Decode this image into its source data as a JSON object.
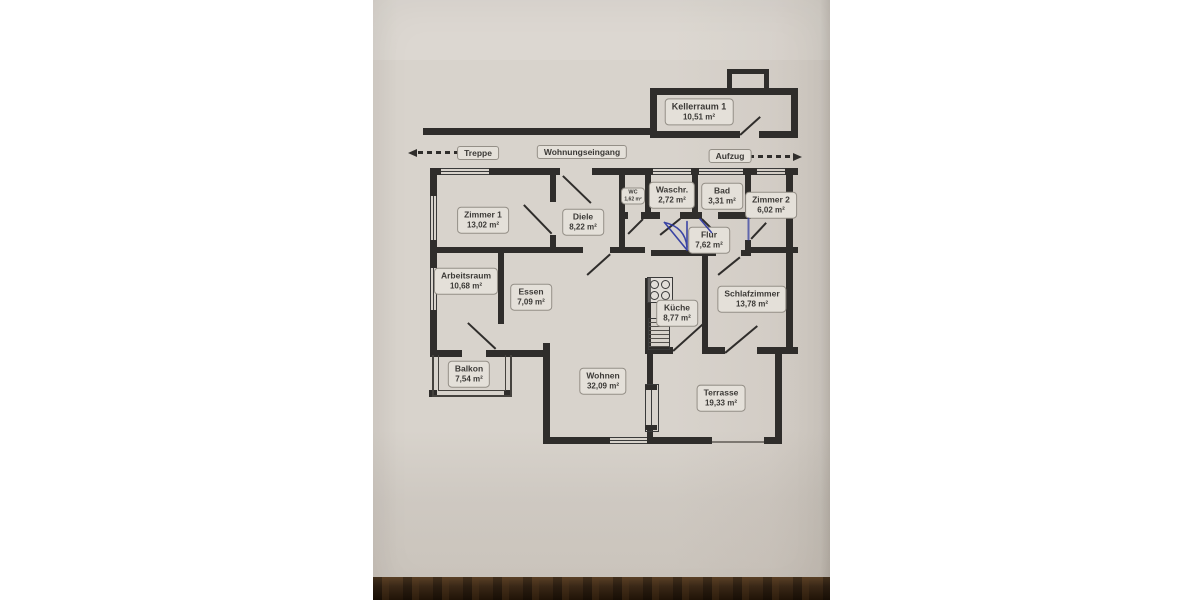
{
  "colors": {
    "canvas": "#ffffff",
    "paper": "#d7d2cb",
    "ink": "#2f2d2b",
    "pen_blue": "#2a35a0",
    "wood": "#3a2817"
  },
  "plan": {
    "rooms": [
      {
        "id": "kellerraum",
        "name": "Kellerraum 1",
        "area": "10,51 m²"
      },
      {
        "id": "zimmer1",
        "name": "Zimmer 1",
        "area": "13,02 m²"
      },
      {
        "id": "diele",
        "name": "Diele",
        "area": "8,22 m²"
      },
      {
        "id": "wc",
        "name": "WC",
        "area": "1,62 m²"
      },
      {
        "id": "waschraum",
        "name": "Waschr.",
        "area": "2,72 m²"
      },
      {
        "id": "bad",
        "name": "Bad",
        "area": "3,31 m²"
      },
      {
        "id": "zimmer2",
        "name": "Zimmer 2",
        "area": "6,02 m²"
      },
      {
        "id": "flur",
        "name": "Flur",
        "area": "7,62 m²"
      },
      {
        "id": "arbeitsraum",
        "name": "Arbeitsraum",
        "area": "10,68 m²"
      },
      {
        "id": "essen",
        "name": "Essen",
        "area": "7,09 m²"
      },
      {
        "id": "kueche",
        "name": "Küche",
        "area": "8,77 m²"
      },
      {
        "id": "schlafzimmer",
        "name": "Schlafzimmer",
        "area": "13,78 m²"
      },
      {
        "id": "balkon",
        "name": "Balkon",
        "area": "7,54 m²"
      },
      {
        "id": "wohnen",
        "name": "Wohnen",
        "area": "32,09 m²"
      },
      {
        "id": "terrasse",
        "name": "Terrasse",
        "area": "19,33 m²"
      }
    ],
    "annotations": {
      "treppe": "Treppe",
      "wohnungseingang": "Wohnungseingang",
      "aufzug": "Aufzug"
    }
  }
}
